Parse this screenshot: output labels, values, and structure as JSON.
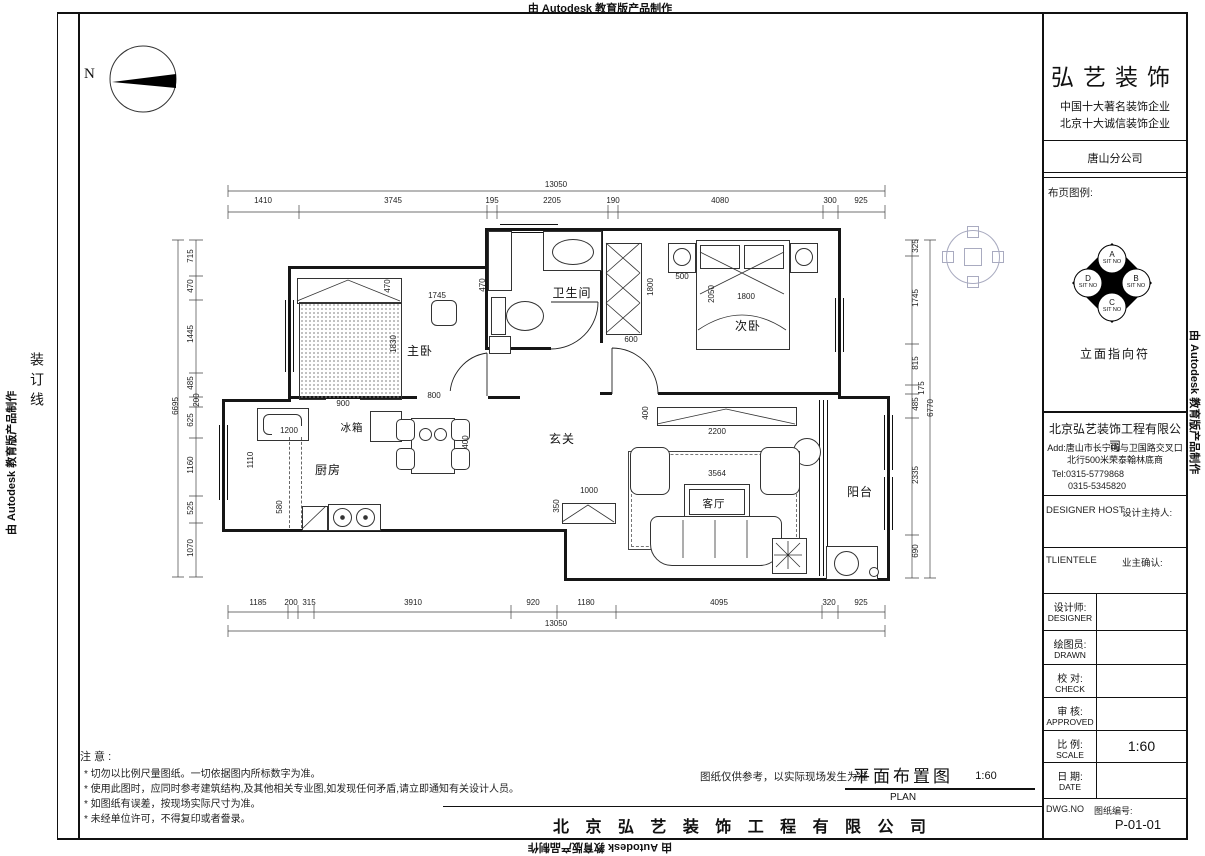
{
  "banner": {
    "autodesk": "由 Autodesk 教育版产品制作",
    "binding_line": "装订线"
  },
  "plan": {
    "north": "N",
    "rooms": {
      "master": "主卧",
      "bath": "卫生间",
      "bed2": "次卧",
      "hall": "玄关",
      "kitchen": "厨房",
      "fridge": "冰箱",
      "living": "客厅",
      "balcony": "阳台"
    },
    "dims": {
      "top_total": "13050",
      "top": [
        "1410",
        "3745",
        "195",
        "2205",
        "190",
        "4080",
        "300",
        "925"
      ],
      "bottom": [
        "1185",
        "200",
        "315",
        "3910",
        "920",
        "1180",
        "4095",
        "320",
        "925"
      ],
      "bottom_total": "13050",
      "left": [
        "715",
        "470",
        "1445",
        "485",
        "200",
        "625",
        "1160",
        "525",
        "1070"
      ],
      "left_total": "6695",
      "right": [
        "325",
        "1745",
        "815",
        "175",
        "485",
        "2335",
        "690"
      ],
      "right_total": "6770",
      "interior": {
        "d1745": "1745",
        "d470a": "470",
        "d470b": "470",
        "d1830": "1830",
        "d900": "900",
        "d800": "800",
        "d1200": "1200",
        "d1110": "1110",
        "d580": "580",
        "d400t": "400",
        "d500": "500",
        "d1800c": "1800",
        "d600": "600",
        "d2050": "2050",
        "d1800b": "1800",
        "d2200": "2200",
        "d400v": "400",
        "d3564": "3564",
        "d1000": "1000",
        "d350": "350"
      }
    }
  },
  "title_block": {
    "brand": "弘艺装饰",
    "slogan1": "中国十大著名装饰企业",
    "slogan2": "北京十大诚信装饰企业",
    "branch": "唐山分公司",
    "legend_label": "布页图例:",
    "elevation_symbol": {
      "label": "立面指向符",
      "letters": [
        "A",
        "B",
        "C",
        "D"
      ],
      "sit": "SIT NO"
    },
    "company": "北京弘艺装饰工程有限公司",
    "address1": "Add:唐山市长宁道与卫国路交叉口",
    "address2": "北行500米荣泰翰林底商",
    "tel1": "Tel:0315-5779868",
    "tel2": "0315-5345820",
    "host_en": "DESIGNER HOST",
    "host_cn": "设计主持人:",
    "client_en": "TLIENTELE",
    "client_cn": "业主确认:",
    "rows": [
      {
        "cn": "设计师:",
        "en": "DESIGNER",
        "value": ""
      },
      {
        "cn": "绘图员:",
        "en": "DRAWN",
        "value": ""
      },
      {
        "cn": "校 对:",
        "en": "CHECK",
        "value": ""
      },
      {
        "cn": "审 核:",
        "en": "APPROVED",
        "value": ""
      },
      {
        "cn": "比 例:",
        "en": "SCALE",
        "value": "1:60"
      },
      {
        "cn": "日 期:",
        "en": "DATE",
        "value": ""
      }
    ],
    "dwg_en": "DWG.NO",
    "dwg_cn": "图纸编号:",
    "dwg_no": "P-01-01"
  },
  "notes": {
    "title": "注 意 :",
    "items": [
      "* 切勿以比例尺量图纸。一切依据图内所标数字为准。",
      "* 使用此图时，应同时参考建筑结构,及其他相关专业图,如发现任何矛盾,请立即通知有关设计人员。",
      "* 如图纸有误差，按现场实际尺寸为准。",
      "* 未经单位许可，不得复印或者誊录。"
    ]
  },
  "footer": {
    "disclaimer": "图纸仅供参考，以实际现场发生为准",
    "plan_title": "平面布置图",
    "plan_scale": "1:60",
    "plan_en": "PLAN",
    "company": "北 京 弘 艺 装 饰 工 程 有 限 公 司"
  }
}
